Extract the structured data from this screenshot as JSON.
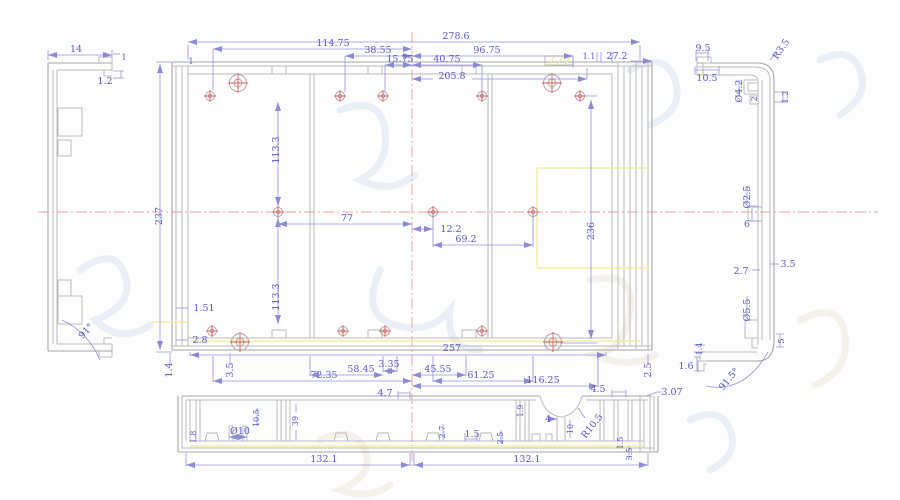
{
  "colors": {
    "dim_text": "#5757c9",
    "dim_line": "#9494da",
    "geometry": "#bababa",
    "centerline": "#e6a3a3",
    "highlight": "#ecec93",
    "hole_marker": "#d96060",
    "watermark": "#d8e1ef"
  },
  "dims": {
    "left_view": {
      "w": "14",
      "lip": "1",
      "t": "1.2",
      "angle": "91°"
    },
    "main_top": {
      "one": "1",
      "overall": "278.6",
      "a": "114.75",
      "b": "38.55",
      "c": "15.75",
      "d": "40.75",
      "e": "96.75",
      "f": "205.8",
      "g": "1.1",
      "h": "27.2"
    },
    "main_left": {
      "a": "1.51",
      "b": "2.8",
      "c": "113.3",
      "d": "113.3",
      "e": "1.4",
      "f": "3.5",
      "g": "237"
    },
    "main_right": {
      "a": "236",
      "b": "2.5"
    },
    "main_mid": {
      "a": "77",
      "b": "12.2",
      "c": "69.2"
    },
    "main_bottom": {
      "a": "257",
      "b": "72.35",
      "c": "58.45",
      "d": "3.35",
      "e": "45.55",
      "f": "61.25",
      "g": "116.25"
    },
    "right_view": {
      "a": "9.5",
      "b": "10.5",
      "c": "R3.5",
      "d": "Ø4.2",
      "e": "2",
      "f": "1.2",
      "g": "Ø2.5",
      "h": "6",
      "i": "3.5",
      "j": "2.7",
      "k": "Ø5.5",
      "l": "5",
      "m": "1.4",
      "n": "1.6",
      "o": "91.5°"
    },
    "bottom_view": {
      "a": "4.7",
      "b": "4.5",
      "c": "3.07",
      "d": "R10.5",
      "e": "4",
      "f": "10",
      "g": "1.9",
      "h": "2.7",
      "i": "1.5",
      "j": "2.5",
      "k": "Ø10",
      "l": "10.5",
      "m": "39",
      "n": "1.8",
      "o": "132.1",
      "p": "132.1",
      "q": "1.5",
      "r": "3.5"
    }
  }
}
